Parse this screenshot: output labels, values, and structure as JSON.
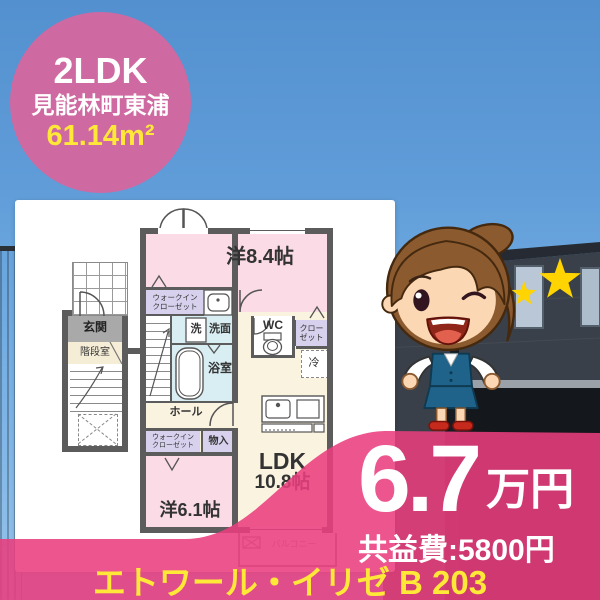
{
  "badge": {
    "layout": "2LDK",
    "location": "見能林町東浦",
    "area": "61.14m²"
  },
  "floorplan": {
    "labels": {
      "main_room": "洋8.4帖",
      "walkin_closet": "ウォークイン\nクローゼット",
      "washer": "洗",
      "washroom": "洗面",
      "bathroom": "浴室",
      "toilet": "WC",
      "closet": "クロー\nゼット",
      "fridge": "冷",
      "hall": "ホール",
      "walkin_closet2": "ウォークイン\nクローゼット",
      "storage": "物入",
      "second_room": "洋6.1帖",
      "ldk": "LDK",
      "ldk_size": "10.8帖",
      "entrance": "玄関",
      "stairwell": "階段室",
      "balcony": "バルコニー"
    }
  },
  "price": {
    "amount": "6.7",
    "unit": "万円",
    "common_fee": "共益費:5800円"
  },
  "building": {
    "name": "エトワール・イリゼ B 203"
  },
  "colors": {
    "accent_pink": "#e93e7d",
    "badge_pink": "#cf69a1",
    "highlight_yellow": "#ffe838",
    "room_pink": "#fadbe6",
    "room_cream": "#faf3e0",
    "room_cyan": "#d9eef3",
    "room_purple": "#d7d1ed",
    "wall_gray": "#5c5c5c",
    "star_yellow": "#ffd400"
  }
}
